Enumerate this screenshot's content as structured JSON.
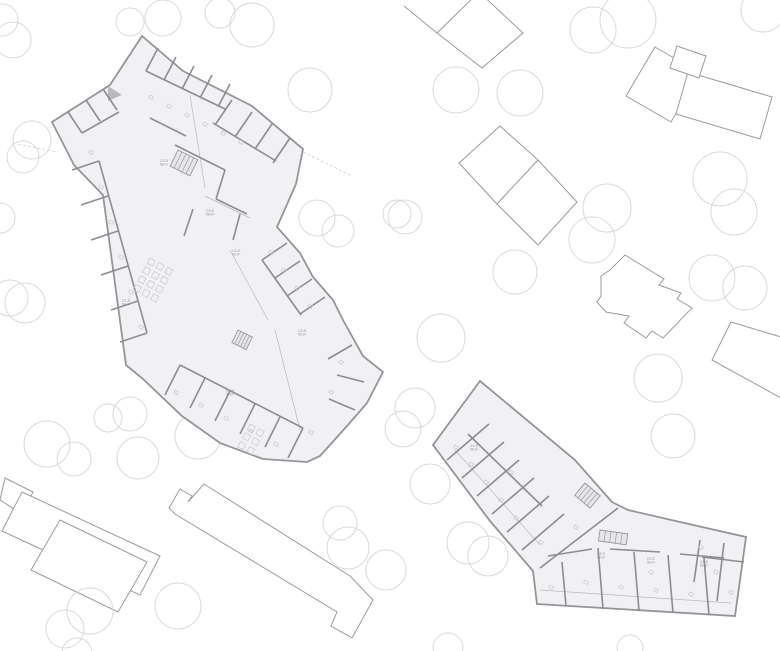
{
  "canvas": {
    "width": 780,
    "height": 651
  },
  "palette": {
    "background": "#ffffff",
    "tree_stroke": "#d9d9d9",
    "outbuilding_stroke": "#9b9b9b",
    "outbuilding_fill": "#ffffff",
    "plan_fill": "#f1f1f3",
    "plan_outline": "#94949a",
    "wall": "#8c8c92",
    "thin_line": "#b9b9be",
    "furniture": "#c9c9ce",
    "stair_fill": "#e6e6ea",
    "stair_stroke": "#8f8f94",
    "label_color": "#8f8f94",
    "site_line": "#d0d0d0"
  },
  "trees": [
    [
      2,
      20,
      16
    ],
    [
      13,
      40,
      18
    ],
    [
      130,
      22,
      14
    ],
    [
      163,
      18,
      18
    ],
    [
      220,
      13,
      15
    ],
    [
      252,
      25,
      22
    ],
    [
      310,
      90,
      22
    ],
    [
      32,
      140,
      19
    ],
    [
      23,
      157,
      16
    ],
    [
      0,
      218,
      15
    ],
    [
      10,
      298,
      18
    ],
    [
      25,
      303,
      20
    ],
    [
      317,
      218,
      18
    ],
    [
      338,
      231,
      16
    ],
    [
      397,
      214,
      14
    ],
    [
      593,
      30,
      23
    ],
    [
      628,
      20,
      28
    ],
    [
      763,
      10,
      22
    ],
    [
      456,
      90,
      23
    ],
    [
      520,
      93,
      23
    ],
    [
      405,
      217,
      17
    ],
    [
      607,
      208,
      24
    ],
    [
      592,
      240,
      23
    ],
    [
      515,
      272,
      22
    ],
    [
      720,
      179,
      27
    ],
    [
      734,
      212,
      23
    ],
    [
      712,
      278,
      23
    ],
    [
      745,
      288,
      22
    ],
    [
      441,
      338,
      24
    ],
    [
      47,
      444,
      23
    ],
    [
      74,
      459,
      17
    ],
    [
      108,
      418,
      14
    ],
    [
      130,
      414,
      17
    ],
    [
      138,
      458,
      21
    ],
    [
      198,
      436,
      23
    ],
    [
      340,
      523,
      17
    ],
    [
      348,
      548,
      21
    ],
    [
      386,
      570,
      20
    ],
    [
      90,
      611,
      23
    ],
    [
      65,
      629,
      19
    ],
    [
      178,
      606,
      23
    ],
    [
      77,
      653,
      15
    ],
    [
      448,
      648,
      15
    ],
    [
      630,
      648,
      13
    ],
    [
      415,
      408,
      20
    ],
    [
      403,
      429,
      18
    ],
    [
      430,
      484,
      20
    ],
    [
      468,
      543,
      21
    ],
    [
      488,
      556,
      20
    ],
    [
      658,
      378,
      24
    ],
    [
      673,
      436,
      22
    ]
  ],
  "outbuildings": [
    {
      "name": "north-pavilion-a",
      "open": true,
      "points": "404,6 437,33 473,1"
    },
    {
      "name": "north-pavilion-b",
      "open": false,
      "points": "437,33 482,68 523,33 479,-8"
    },
    {
      "name": "northeast-slab-a",
      "open": false,
      "points": "626,96 655,47 700,73 671,122"
    },
    {
      "name": "northeast-slab-b",
      "open": false,
      "points": "688,72 772,97 760,139 676,114"
    },
    {
      "name": "northeast-slab-c",
      "open": false,
      "points": "677,46 706,56 699,78 670,68"
    },
    {
      "name": "east-pavilion-a",
      "open": false,
      "points": "500,126 538,160 497,204 459,163"
    },
    {
      "name": "east-pavilion-b",
      "open": false,
      "points": "538,160 577,202 538,245 497,204"
    },
    {
      "name": "east-stepped-house",
      "open": false,
      "points": "625,255 664,279 659,285 681,293 677,299 692,308 663,338 652,331 646,338 624,323 629,316 606,312 597,302 601,296 601,276 610,270"
    },
    {
      "name": "far-east-slab",
      "open": false,
      "points": "731,322 781,337 781,398 712,360"
    },
    {
      "name": "southwest-block",
      "open": false,
      "points": "5,478 33,492 22,514 0,500"
    },
    {
      "name": "southwest-slab-a",
      "open": false,
      "points": "22,492 160,556 140,595 2,531"
    },
    {
      "name": "southwest-slab-b",
      "open": false,
      "points": "60,520 147,562 118,612 31,570"
    },
    {
      "name": "south-bar",
      "open": false,
      "points": "204,484 350,576 373,600 352,638 331,626 337,612 175,514 169,508 180,489 192,496 188,502"
    }
  ],
  "site_lines": [
    {
      "name": "boundary-east",
      "points": "303,152 352,176"
    },
    {
      "name": "boundary-west",
      "points": "18,144 58,152"
    },
    {
      "name": "corridor-arc",
      "points": "186,252 200,246 213,253"
    }
  ],
  "plans": [
    {
      "name": "building-a",
      "outline": "142,36 183,71 252,106 303,149 296,184 277,227 300,253 313,277 333,300 343,320 363,356 383,372 367,403 347,426 320,456 307,462 263,459 220,443 182,416 143,379 126,365 103,195 74,165 52,122 110,85",
      "junction_triangles": [
        "108,86 122,95 108,101"
      ],
      "walls": [
        "158,48 146,71",
        "176,57 164,80",
        "194,66 182,89",
        "212,75 200,98",
        "230,84 218,107",
        "146,71 225,109",
        "232,100 215,125",
        "252,112 235,137",
        "272,124 255,149",
        "290,138 273,163",
        "213,123 276,161",
        "68,112 82,133",
        "86,100 100,121",
        "103,89 117,110",
        "82,133 119,112",
        "72,170 99,161",
        "81,205 108,196",
        "91,240 118,231",
        "101,275 128,266",
        "111,310 138,301",
        "120,342 147,333",
        "99,161 147,333",
        "287,243 262,260",
        "300,261 275,278",
        "312,279 287,296",
        "325,297 300,314",
        "262,260 301,315",
        "165,395 180,365",
        "190,408 205,378",
        "215,421 230,391",
        "240,434 255,404",
        "265,447 280,417",
        "288,458 303,428",
        "180,365 303,428",
        "352,345 328,359",
        "364,382 337,375",
        "355,410 329,399",
        "175,145 225,170",
        "225,170 216,199",
        "216,199 247,214",
        "193,209 184,236",
        "240,214 233,240",
        "150,118 186,136"
      ],
      "thin_lines": [
        "190,95 205,188",
        "205,196 250,218",
        "230,250 268,320",
        "275,330 300,430"
      ],
      "stairs": [
        {
          "x": 178,
          "y": 150,
          "w": 22,
          "h": 18,
          "angle": 26
        },
        {
          "x": 238,
          "y": 330,
          "w": 16,
          "h": 14,
          "angle": 26
        }
      ],
      "table_grids": [
        {
          "x": 150,
          "y": 258,
          "cols": 3,
          "rows": 4,
          "pitch": 10,
          "size": 6,
          "angle": 28
        },
        {
          "x": 250,
          "y": 424,
          "cols": 2,
          "rows": 3,
          "pitch": 10,
          "size": 6,
          "angle": 28
        }
      ],
      "furniture": [
        [
          150,
          95
        ],
        [
          168,
          104
        ],
        [
          186,
          113
        ],
        [
          204,
          122
        ],
        [
          222,
          131
        ],
        [
          240,
          140
        ],
        [
          90,
          150
        ],
        [
          100,
          185
        ],
        [
          110,
          220
        ],
        [
          120,
          255
        ],
        [
          130,
          290
        ],
        [
          140,
          325
        ],
        [
          270,
          250
        ],
        [
          283,
          268
        ],
        [
          296,
          286
        ],
        [
          309,
          304
        ],
        [
          175,
          390
        ],
        [
          200,
          403
        ],
        [
          225,
          416
        ],
        [
          250,
          429
        ],
        [
          275,
          442
        ],
        [
          340,
          360
        ],
        [
          330,
          390
        ],
        [
          310,
          430
        ]
      ],
      "labels": [
        {
          "x": 160,
          "y": 162,
          "lines": [
            "2.5 Zi",
            "58 m²"
          ]
        },
        {
          "x": 206,
          "y": 212,
          "lines": [
            "2.5 Zi",
            "58 m²"
          ]
        },
        {
          "x": 232,
          "y": 252,
          "lines": [
            "1.5 Zi",
            "42 m²"
          ]
        },
        {
          "x": 122,
          "y": 302,
          "lines": [
            "2.5 Zi",
            "58 m²"
          ]
        },
        {
          "x": 226,
          "y": 392,
          "lines": [
            "2.5 Zi",
            "58 m²"
          ]
        },
        {
          "x": 298,
          "y": 332,
          "lines": [
            "1.5 Zi",
            "42 m²"
          ]
        }
      ]
    },
    {
      "name": "building-b",
      "outline": "480,381 575,460 612,502 628,510 680,522 746,537 735,616 537,604 533,571 490,521 433,445",
      "junction_triangles": [],
      "walls": [
        "447,460 489,424",
        "462,478 504,442",
        "477,496 519,460",
        "492,514 534,478",
        "507,532 549,496",
        "522,550 564,514",
        "468,434 542,506",
        "562,562 566,606",
        "598,548 603,609",
        "634,552 639,611",
        "668,555 673,613",
        "704,558 709,615",
        "548,556 592,549",
        "610,549 660,552",
        "680,554 724,558",
        "700,540 694,582",
        "724,543 717,601",
        "744,562 702,557",
        "540,568 618,508"
      ],
      "thin_lines": [
        "540,590 731,603",
        "455,450 540,545"
      ],
      "stairs": [
        {
          "x": 585,
          "y": 483,
          "w": 20,
          "h": 16,
          "angle": 40
        },
        {
          "x": 600,
          "y": 530,
          "w": 28,
          "h": 11,
          "angle": 8
        }
      ],
      "table_grids": [],
      "furniture": [
        [
          455,
          445
        ],
        [
          470,
          462
        ],
        [
          485,
          480
        ],
        [
          500,
          498
        ],
        [
          515,
          516
        ],
        [
          550,
          585
        ],
        [
          585,
          580
        ],
        [
          620,
          585
        ],
        [
          655,
          588
        ],
        [
          690,
          592
        ],
        [
          715,
          570
        ],
        [
          730,
          590
        ],
        [
          510,
          470
        ],
        [
          540,
          540
        ],
        [
          575,
          525
        ],
        [
          650,
          570
        ],
        [
          700,
          545
        ]
      ],
      "labels": [
        {
          "x": 597,
          "y": 555,
          "lines": [
            "3.5 Zi",
            "82 m²"
          ]
        },
        {
          "x": 647,
          "y": 560,
          "lines": [
            "2.5 Zi",
            "58 m²"
          ]
        },
        {
          "x": 700,
          "y": 563,
          "lines": [
            "3.5 Zi",
            "82 m²"
          ]
        },
        {
          "x": 470,
          "y": 447,
          "lines": [
            "2.5 Zi",
            "58 m²"
          ]
        }
      ]
    }
  ]
}
